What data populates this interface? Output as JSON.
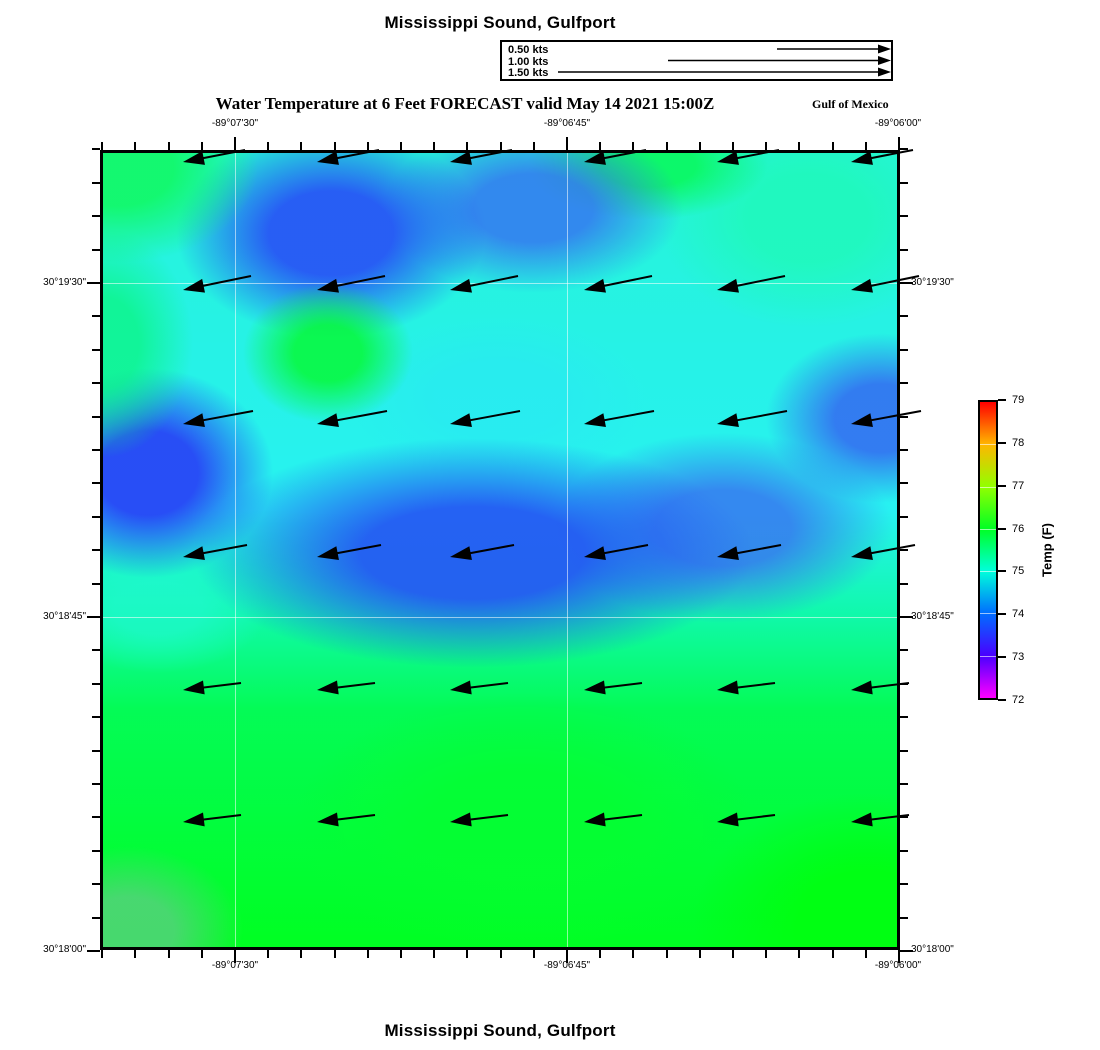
{
  "page": {
    "background": "#ffffff"
  },
  "header": {
    "title": "Mississippi Sound, Gulfport",
    "subtitle": "Water Temperature at 6 Feet FORECAST valid May 14 2021 15:00Z",
    "annotation": "Gulf of Mexico"
  },
  "footer": {
    "title": "Mississippi Sound, Gulfport"
  },
  "legend": {
    "entries": [
      {
        "label": "0.50 kts",
        "speed_kts": 0.5,
        "line_start_px": 777
      },
      {
        "label": "1.00 kts",
        "speed_kts": 1.0,
        "line_start_px": 668
      },
      {
        "label": "1.50 kts",
        "speed_kts": 1.5,
        "line_start_px": 558
      }
    ],
    "arrow_tip_px": 891,
    "rows_y_px": [
      49,
      60.5,
      72
    ]
  },
  "colors": {
    "frame": "#000000",
    "arrow": "#000000",
    "grid": "rgba(255,255,255,0.55)"
  },
  "chart_data": {
    "type": "heatmap",
    "subtype": "geographic water-temperature field with surface current vectors",
    "title": "Water Temperature at 6 Feet FORECAST valid May 14 2021 15:00Z",
    "region": "Mississippi Sound, Gulfport",
    "valid_time": "May 14 2021 15:00Z",
    "plot_px": {
      "left": 100,
      "top": 150,
      "width": 800,
      "height": 800
    },
    "x_axis": {
      "name": "longitude",
      "ticks": [
        {
          "text": "-89°07'30\"",
          "px": 235
        },
        {
          "text": "-89°06'45\"",
          "px": 567
        },
        {
          "text": "-89°06'00\"",
          "px": 898
        }
      ],
      "anchor_px": 235,
      "minor_step_px": 33.2
    },
    "y_axis": {
      "name": "latitude",
      "ticks": [
        {
          "text": "30°19'30\"",
          "px": 283
        },
        {
          "text": "30°18'45\"",
          "px": 617
        },
        {
          "text": "30°18'00\"",
          "px": 950
        }
      ],
      "anchor_px": 283,
      "minor_step_px": 33.4
    },
    "grid": {
      "x_px": [
        235,
        567
      ],
      "y_px": [
        283,
        617
      ]
    },
    "colorbar": {
      "label": "Temp (F)",
      "min": 72,
      "max": 79,
      "ticks": [
        79,
        78,
        77,
        76,
        75,
        74,
        73,
        72
      ],
      "scheme": "rainbow: magenta(72) → blue(73) → cyan(75) → green(76) → yellow(77.5) → red(79)",
      "px": {
        "left": 978,
        "top": 400,
        "width": 20,
        "height": 300
      }
    },
    "vectors": {
      "units": "kts",
      "approx_speed_kts": 0.3,
      "direction": "westward, slight southward component",
      "cols_px": [
        183,
        317,
        450,
        584,
        717,
        851
      ],
      "rows_px": [
        162,
        290,
        424,
        557,
        690,
        822
      ],
      "row_geometry": [
        {
          "len": 62,
          "rise": 12
        },
        {
          "len": 68,
          "rise": 14
        },
        {
          "len": 70,
          "rise": 13
        },
        {
          "len": 64,
          "rise": 12
        },
        {
          "len": 58,
          "rise": 7
        },
        {
          "len": 58,
          "rise": 7
        }
      ]
    },
    "field": {
      "summary": "Cool pools (~73-74 F, blue) across the northern and central band; ambient ~75 F cyan-teal; uniform warm ~76 F green across the southern third, warmest (~76.5 F) in the southeast corner.",
      "base_stops": [
        {
          "at": 0.0,
          "color": "hsl(172,90%,55%)"
        },
        {
          "at": 0.45,
          "color": "hsl(180,88%,55%)"
        },
        {
          "at": 0.58,
          "color": "hsl(160,95%,52%)"
        },
        {
          "at": 0.7,
          "color": "hsl(140,97%,50%)"
        },
        {
          "at": 1.0,
          "color": "hsl(128,100%,50%)"
        }
      ],
      "patches": [
        {
          "name": "green-spot-upper-left-center",
          "cx": 225,
          "cy": 200,
          "rx": 85,
          "ry": 70,
          "color": "hsla(132,95%,50%,0.85)",
          "approx_f": 76.2
        },
        {
          "name": "green-northwest-corner",
          "cx": 15,
          "cy": 15,
          "rx": 140,
          "ry": 95,
          "color": "hsla(140,95%,52%,0.85)",
          "approx_f": 76.0
        },
        {
          "name": "green-west-edge",
          "cx": 0,
          "cy": 190,
          "rx": 90,
          "ry": 115,
          "color": "hsla(150,92%,50%,0.75)",
          "approx_f": 75.8
        },
        {
          "name": "cool-pool-north",
          "cx": 228,
          "cy": 80,
          "rx": 155,
          "ry": 105,
          "color": "hsla(228,92%,56%,0.92)",
          "approx_f": 73.8
        },
        {
          "name": "cool-patch-north-center",
          "cx": 430,
          "cy": 55,
          "rx": 150,
          "ry": 85,
          "color": "hsla(222,88%,58%,0.80)",
          "approx_f": 74.2
        },
        {
          "name": "green-top-center",
          "cx": 545,
          "cy": 12,
          "rx": 120,
          "ry": 55,
          "color": "hsla(138,95%,50%,0.80)",
          "approx_f": 76.0
        },
        {
          "name": "teal-northeast",
          "cx": 705,
          "cy": 65,
          "rx": 150,
          "ry": 110,
          "color": "hsla(162,95%,55%,0.80)",
          "approx_f": 75.4
        },
        {
          "name": "cool-pool-west",
          "cx": 45,
          "cy": 320,
          "rx": 125,
          "ry": 105,
          "color": "hsla(233,92%,56%,0.92)",
          "approx_f": 73.2
        },
        {
          "name": "cool-band-center",
          "cx": 370,
          "cy": 400,
          "rx": 280,
          "ry": 115,
          "color": "hsla(226,90%,55%,0.92)",
          "approx_f": 73.6
        },
        {
          "name": "cool-band-east",
          "cx": 620,
          "cy": 375,
          "rx": 170,
          "ry": 95,
          "color": "hsla(222,86%,58%,0.80)",
          "approx_f": 74.2
        },
        {
          "name": "cool-patch-east-edge",
          "cx": 778,
          "cy": 265,
          "rx": 115,
          "ry": 85,
          "color": "hsla(227,88%,58%,0.80)",
          "approx_f": 74.2
        },
        {
          "name": "teal-pocket-west",
          "cx": 55,
          "cy": 455,
          "rx": 110,
          "ry": 65,
          "color": "hsla(168,95%,55%,0.70)",
          "approx_f": 75.2
        },
        {
          "name": "cyan-mid-north",
          "cx": 395,
          "cy": 245,
          "rx": 150,
          "ry": 85,
          "color": "hsla(184,90%,56%,0.55)",
          "approx_f": 74.8
        },
        {
          "name": "muted-green-southwest-corner",
          "cx": 25,
          "cy": 778,
          "rx": 115,
          "ry": 85,
          "color": "hsla(140,55%,58%,0.80)",
          "approx_f": 75.8
        },
        {
          "name": "bright-green-southeast",
          "cx": 765,
          "cy": 770,
          "rx": 175,
          "ry": 130,
          "color": "hsla(123,100%,50%,0.80)",
          "approx_f": 76.4
        },
        {
          "name": "green-south-center",
          "cx": 420,
          "cy": 670,
          "rx": 230,
          "ry": 130,
          "color": "hsla(130,100%,51%,0.70)",
          "approx_f": 76.2
        }
      ]
    }
  }
}
